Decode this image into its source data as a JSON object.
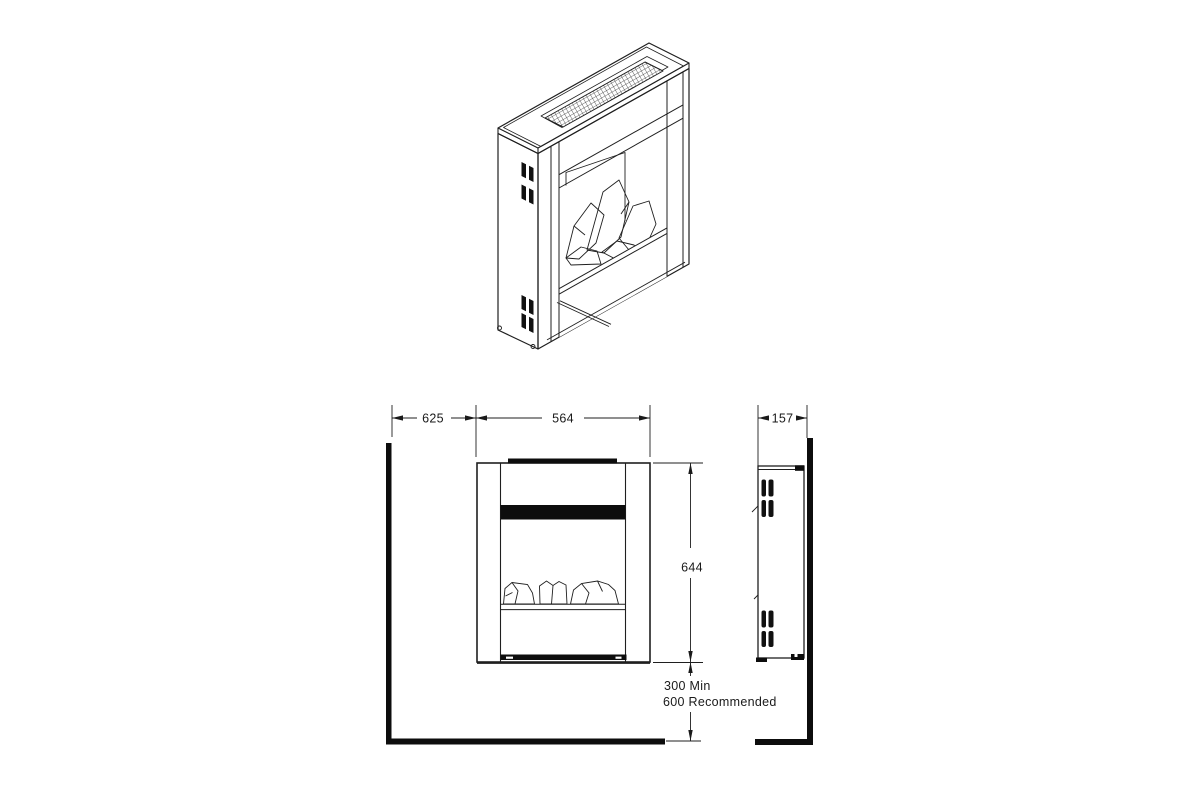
{
  "document": {
    "type": "technical-installation-drawing",
    "background": "#ffffff",
    "line_color": "#1a1a1a",
    "fill_color": "#000000"
  },
  "dimensions": {
    "wall_to_unit": "625",
    "unit_width": "564",
    "unit_height": "644",
    "unit_depth": "157",
    "clearance_line1": "300 Min",
    "clearance_line2": "600 Recommended"
  }
}
